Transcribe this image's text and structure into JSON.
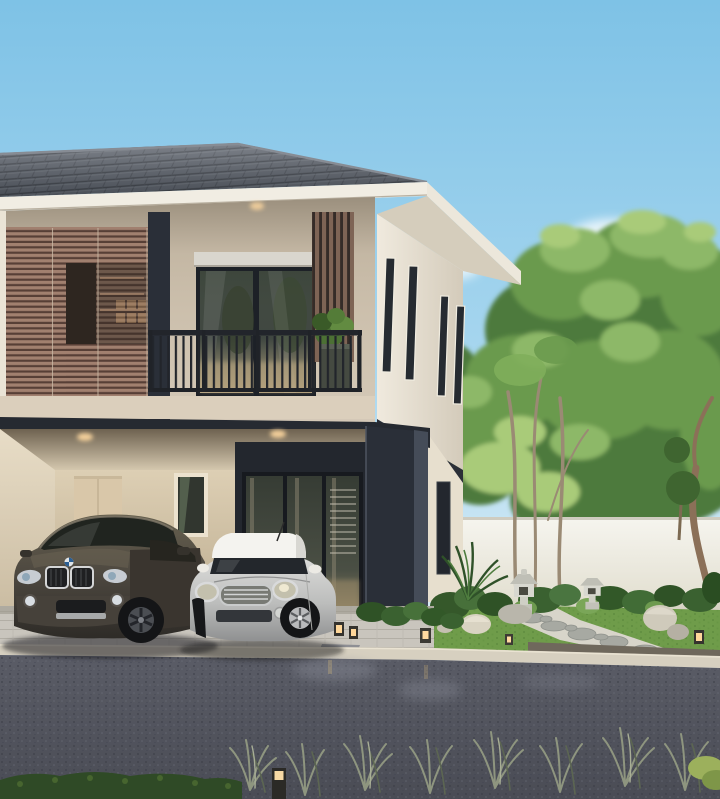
{
  "meta": {
    "title": "3D architectural rendering: modern two-story house at dusk with carport, two parked cars and landscaped zen garden",
    "width": 720,
    "height": 799
  },
  "palette": {
    "sky_top": "#7ec2e6",
    "sky_mid": "#a9d7ef",
    "sky_horizon": "#e6f2f8",
    "cloud": "#ffffff",
    "roof": "#5a606a",
    "roof_line": "#3e434b",
    "fascia": "#f1ede3",
    "wall_front": "#cdc0ac",
    "wall_side": "#ebe3d3",
    "wall_shadow": "#a89c88",
    "louver_light": "#a1806f",
    "louver_dark": "#573f36",
    "charcoal": "#2a2f38",
    "charcoal_light": "#454c58",
    "glass": "#454e44",
    "glass_warm": "#b2a07c",
    "railing": "#22252b",
    "carport_wall": "#d5c7ad",
    "door_tan": "#d9c7a9",
    "floor": "#c9c5bd",
    "curb": "#d7d0c0",
    "road": "#53555f",
    "road_sheen": "#8e919c",
    "grass": "#6f9c4a",
    "bush": "#35582a",
    "bush_light": "#5d8a42",
    "tree_dark": "#4e7a3c",
    "tree_mid": "#6a9a4e",
    "tree_light": "#8db867",
    "tree_bright": "#a9cb79",
    "garden_wall": "#f2f1ea",
    "stone": "#b9bbb3",
    "gravel": "#d8d5ca",
    "trunk": "#9a8a74",
    "suv_body": "#55504a",
    "mini_body": "#c6c6c4",
    "mini_roof": "#f4f3ef",
    "light_glow": "#ffd9a0"
  },
  "scene": {
    "house": {
      "style": "modern two-story",
      "roof": "gray hipped tile roof with white fascia gutter",
      "second_floor": "beige facade, brown horizontal louver screen, black steel balcony railing, sliding glass door with roller shade, vertical wood slat screen, potted balcony plant",
      "side_wall": "light cream wall with four narrow slit windows",
      "first_floor": "open carport with recessed downlights, tan entry door, charcoal feature wall with glass sliding doors, charcoal portal frame column"
    },
    "vehicles": {
      "suv": "dark bronze-gray luxury SUV with twin-kidney chrome grille",
      "hatchback": "silver compact hatchback with white roof and chrome oval headlights"
    },
    "garden": {
      "elements": "white boundary wall, tall green trees, slender multi-trunk tree, two stone pagoda lanterns, boulders, clipped bushes, cycad, stepping-stone gravel path, lawn"
    },
    "ground": {
      "elements": "light paver carport apron, concrete curb, dark block-paved road with light reflections, cube bollard lights, low hedge and ornamental sage grasses in foreground"
    },
    "lighting": "dusk ambience, warm downlights and bollard glows"
  }
}
